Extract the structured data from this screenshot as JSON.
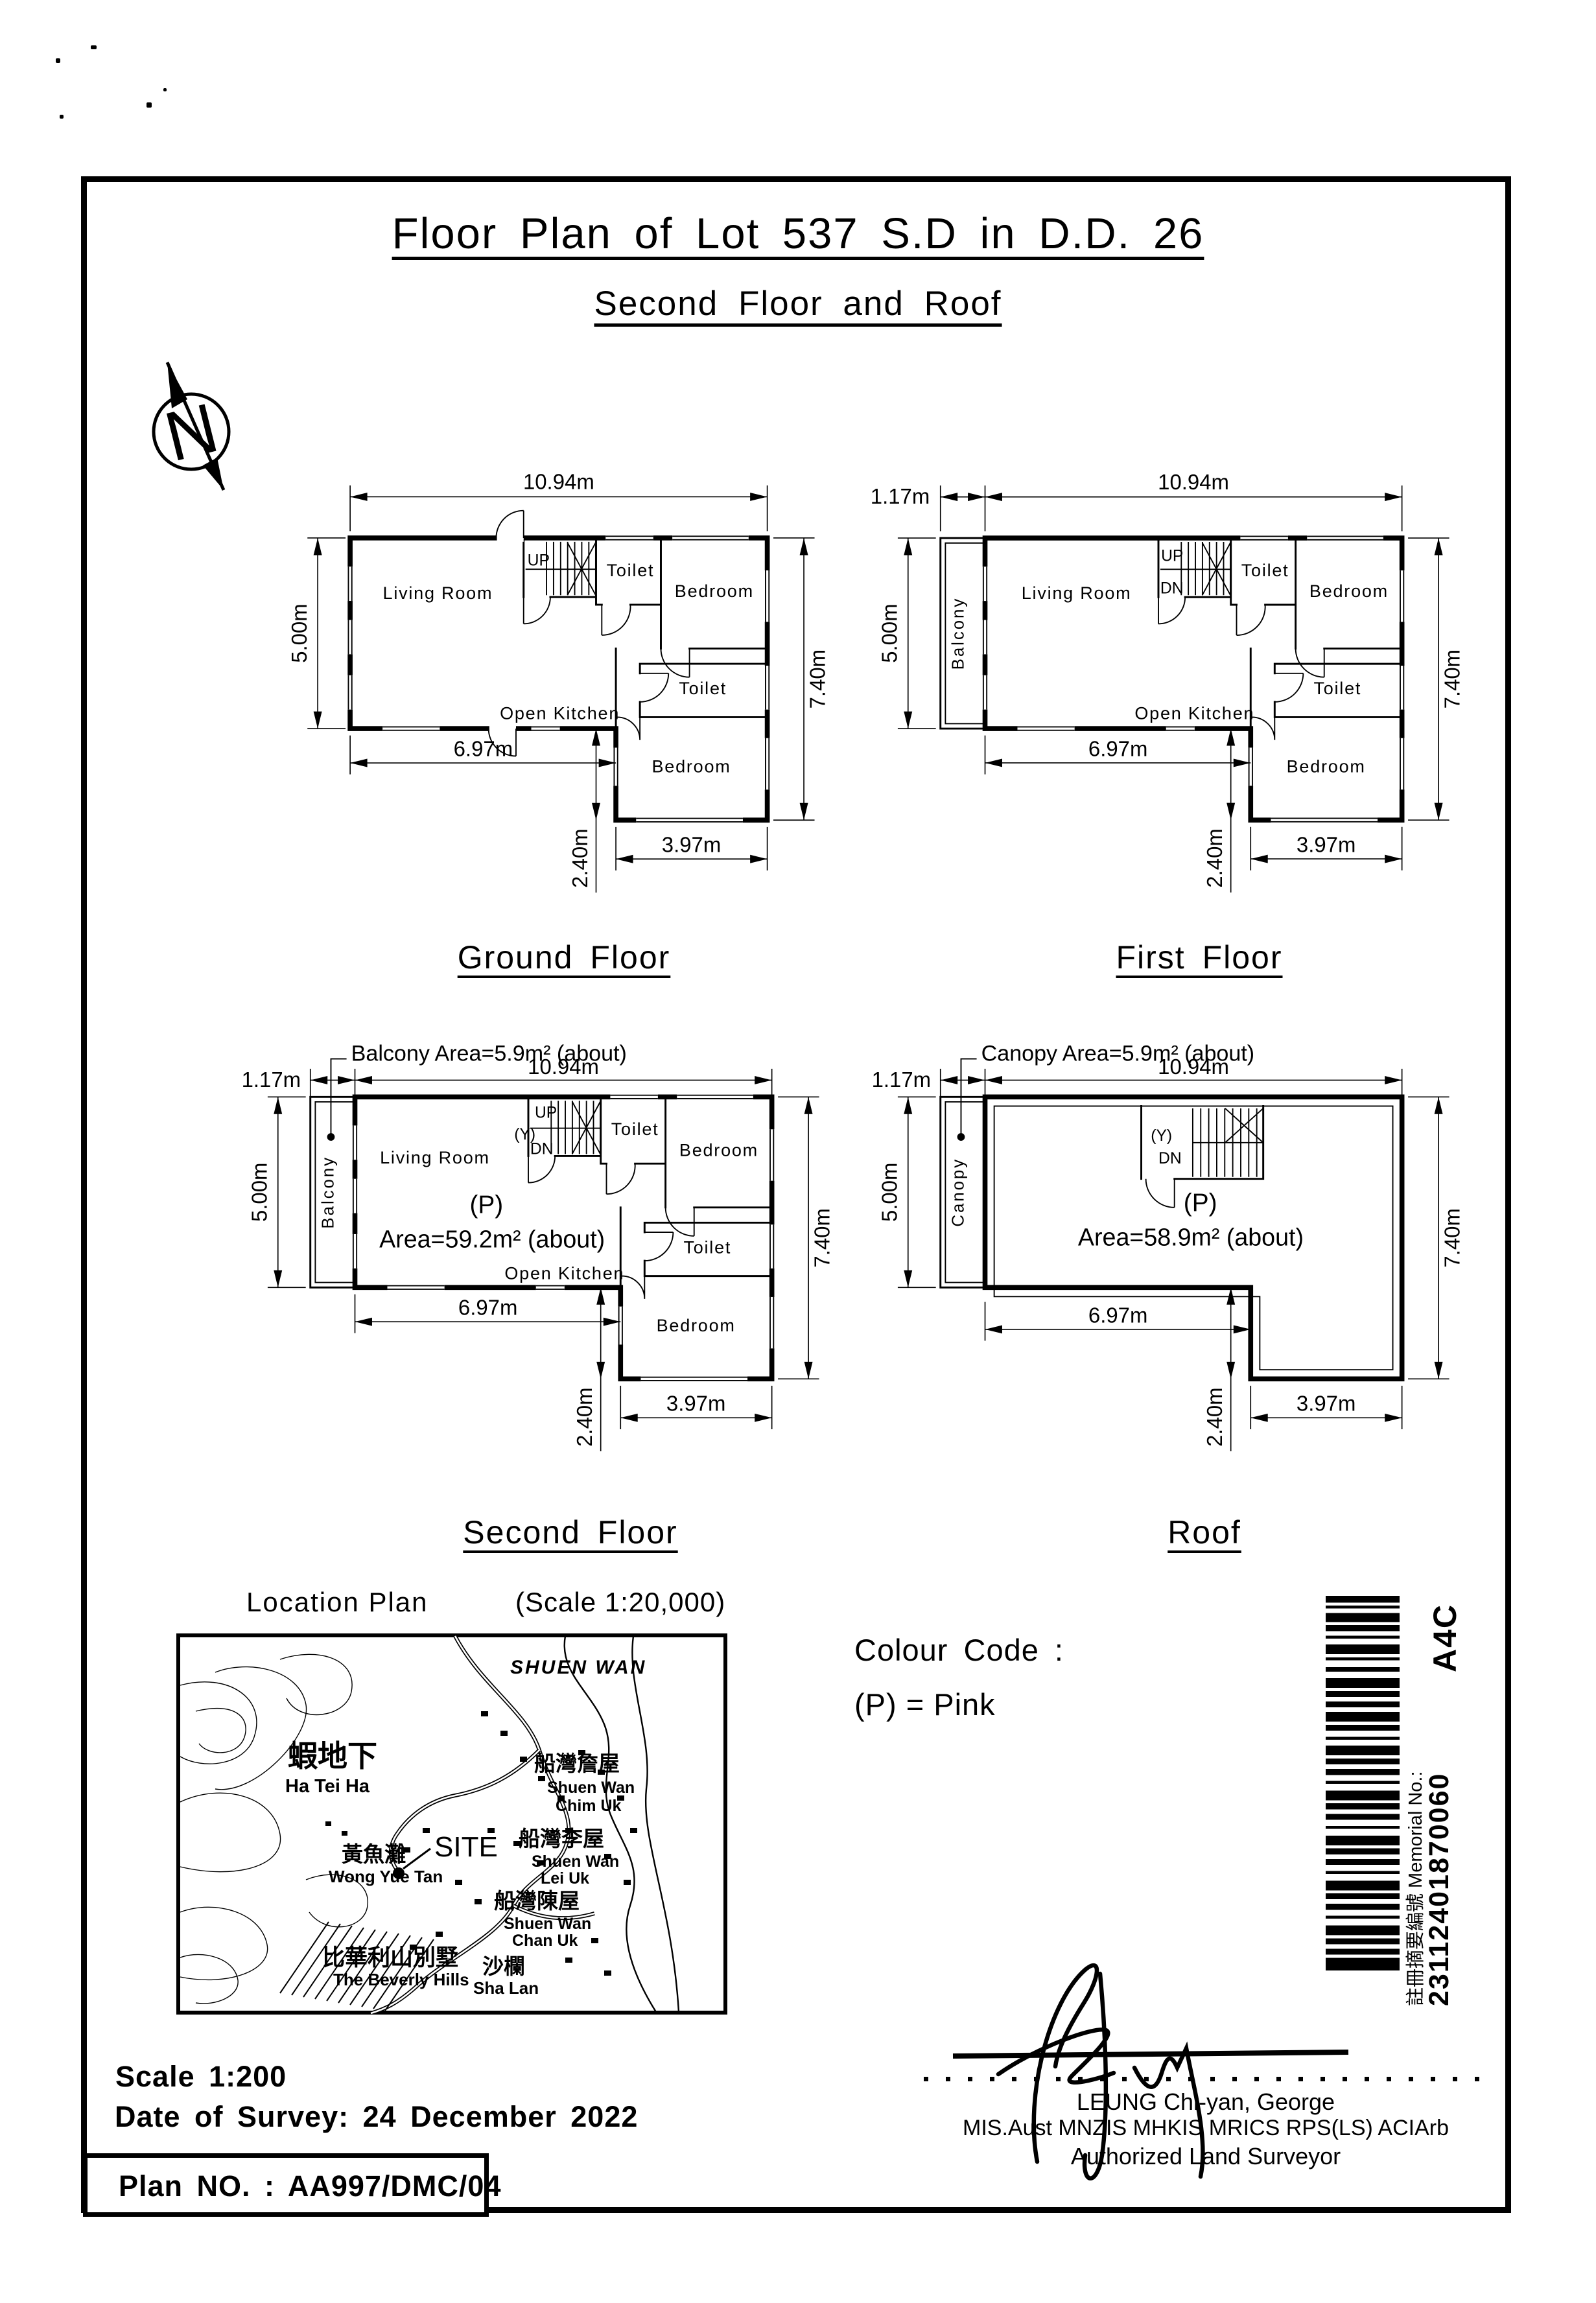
{
  "page": {
    "title": "Floor Plan of Lot 537 S.D in D.D. 26",
    "subtitle": "Second Floor and Roof"
  },
  "north": {
    "letter": "N"
  },
  "floors": {
    "ground": {
      "title": "Ground Floor",
      "living": "Living Room",
      "kitchen": "Open Kitchen",
      "toilet": "Toilet",
      "bedroom": "Bedroom",
      "up": "UP",
      "dims": {
        "w": "10.94m",
        "lh": "5.00m",
        "rh": "7.40m",
        "bl": "6.97m",
        "br": "3.97m",
        "wing": "2.40m"
      }
    },
    "first": {
      "title": "First Floor",
      "living": "Living Room",
      "kitchen": "Open Kitchen",
      "toilet": "Toilet",
      "bedroom": "Bedroom",
      "balcony": "Balcony",
      "up": "UP",
      "dn": "DN",
      "dims": {
        "w": "10.94m",
        "lh": "5.00m",
        "rh": "7.40m",
        "bl": "6.97m",
        "br": "3.97m",
        "wing": "2.40m",
        "bal": "1.17m"
      }
    },
    "second": {
      "title": "Second Floor",
      "living": "Living Room",
      "kitchen": "Open Kitchen",
      "toilet": "Toilet",
      "bedroom": "Bedroom",
      "balcony": "Balcony",
      "up": "UP",
      "dn": "DN",
      "y": "(Y)",
      "p": "(P)",
      "annotation": "Balcony Area=5.9m² (about)",
      "area": "Area=59.2m² (about)",
      "dims": {
        "w": "10.94m",
        "lh": "5.00m",
        "rh": "7.40m",
        "bl": "6.97m",
        "br": "3.97m",
        "wing": "2.40m",
        "bal": "1.17m"
      }
    },
    "roof": {
      "title": "Roof",
      "canopy": "Canopy",
      "dn": "DN",
      "y": "(Y)",
      "p": "(P)",
      "annotation": "Canopy Area=5.9m² (about)",
      "area": "Area=58.9m² (about)",
      "dims": {
        "w": "10.94m",
        "lh": "5.00m",
        "rh": "7.40m",
        "bl": "6.97m",
        "br": "3.97m",
        "wing": "2.40m",
        "bal": "1.17m"
      }
    }
  },
  "location": {
    "title": "Location Plan",
    "scale": "(Scale 1:20,000)",
    "site": "SITE",
    "labels": {
      "shuen_wan": "SHUEN WAN",
      "ha_tei_ha_zh": "蝦地下",
      "ha_tei_ha": "Ha Tei Ha",
      "wong_yue_tan_zh": "黃魚灘",
      "wong_yue_tan": "Wong Yue Tan",
      "chim_uk_zh": "船灣詹屋",
      "chim_uk_1": "Shuen Wan",
      "chim_uk_2": "Chim Uk",
      "lei_uk_zh": "船灣李屋",
      "lei_uk_1": "Shuen Wan",
      "lei_uk_2": "Lei Uk",
      "chan_uk_zh": "船灣陳屋",
      "chan_uk_1": "Shuen Wan",
      "chan_uk_2": "Chan Uk",
      "beverly_zh": "比華利山別墅",
      "beverly": "The Beverly Hills",
      "sha_lan_zh": "沙欄",
      "sha_lan": "Sha Lan"
    }
  },
  "colour_code": {
    "title": "Colour Code :",
    "entry": "(P)  =  Pink"
  },
  "barcode": {
    "code": "A4C",
    "label": "註冊摘要編號 Memorial No.:",
    "number": "23112401870060"
  },
  "surveyor": {
    "name": "LEUNG Chi-yan, George",
    "quals": "MIS.Aust MNZIS MHKIS MRICS RPS(LS) ACIArb",
    "role": "Authorized Land Surveyor"
  },
  "footer": {
    "scale": "Scale 1:200",
    "survey_date": "Date of Survey: 24 December 2022",
    "plan_no": "Plan NO. : AA997/DMC/04"
  }
}
